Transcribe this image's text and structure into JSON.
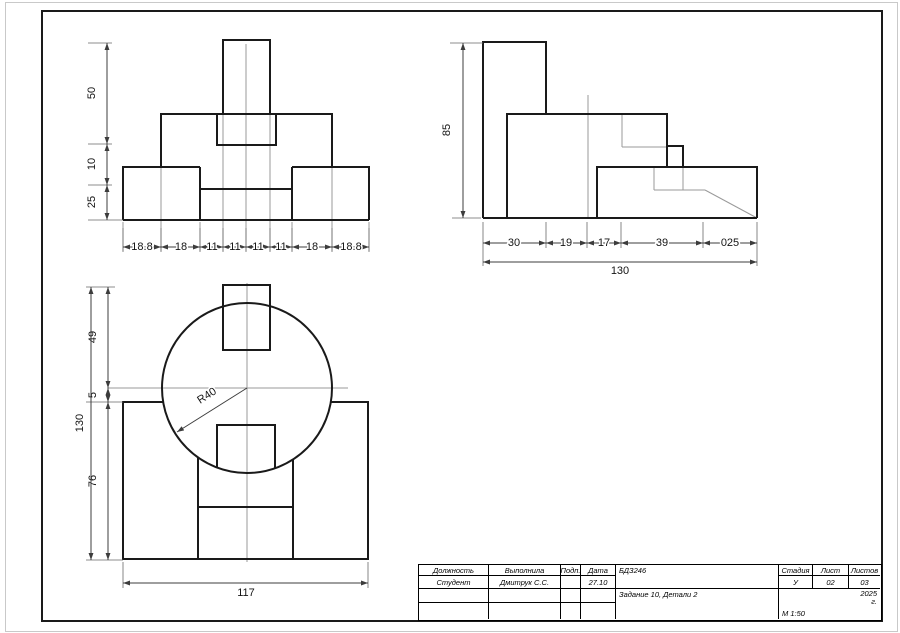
{
  "drawing": {
    "front_view": {
      "dims_left": [
        "50",
        "10",
        "25"
      ],
      "dims_bottom": [
        "18.8",
        "18",
        "11",
        "11",
        "11",
        "11",
        "18",
        "18.8"
      ]
    },
    "side_view": {
      "dim_left": "85",
      "dims_bottom": [
        "30",
        "19",
        "17",
        "39",
        "025"
      ],
      "dim_total_bottom": "130"
    },
    "top_view": {
      "dims_left": [
        "49",
        "5",
        "76"
      ],
      "dim_total_left": "130",
      "dim_bottom": "117",
      "radius_label": "R40"
    }
  },
  "title_block": {
    "headers": {
      "position": "Должность",
      "executed_by": "Выполнила",
      "signature": "Подп.",
      "date": "Дата",
      "stage": "Стадия",
      "sheet": "Лист",
      "sheets": "Листов"
    },
    "values": {
      "position": "Студент",
      "executed_by": "Дмитрук С.С.",
      "date": "27.10",
      "stage": "У",
      "sheet": "02",
      "sheets": "03"
    },
    "doc_code": "БДЗ246",
    "doc_title": "Задание 10,  Детали 2",
    "year": "2025",
    "year_suffix": "г.",
    "scale": "М 1:50"
  },
  "colors": {
    "main_line": "#1a1a1a",
    "thin_line": "#9a9a9a",
    "dim_line": "#3c3c3c"
  }
}
